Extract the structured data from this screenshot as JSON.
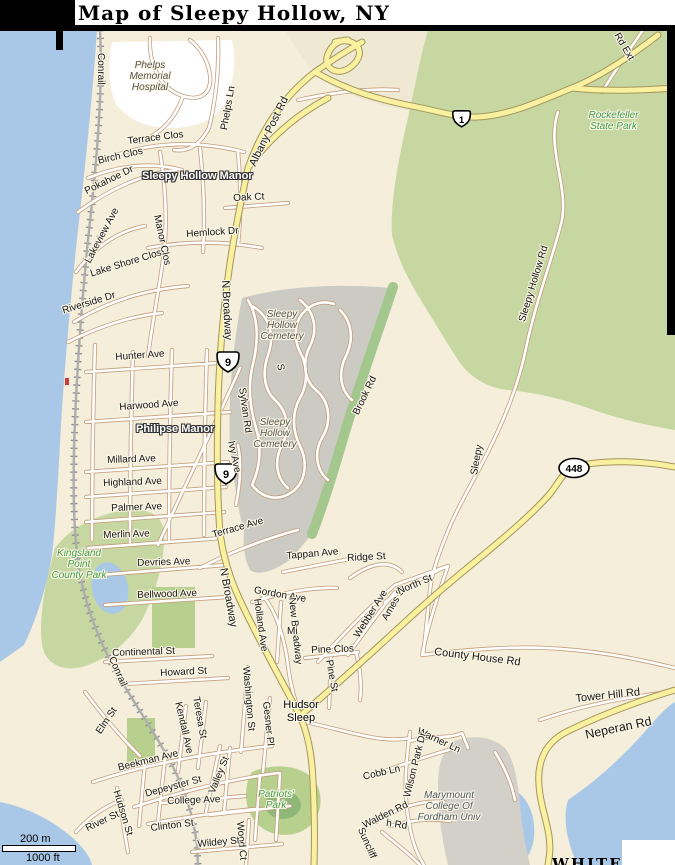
{
  "title": "Map of Sleepy Hollow, NY",
  "scale_bar": {
    "metric": "200 m",
    "imperial": "1000 ft"
  },
  "route_shields": {
    "us9": "9",
    "ny448": "448",
    "route1": "1"
  },
  "colors": {
    "water": "#A9C7E6",
    "park_green": "#C6D7A1",
    "cemetery_gray": "#CBCBC3",
    "major_road": "#FAF1A0",
    "minor_casing": "#C49E7C",
    "land": "#F4EEDA"
  },
  "labels": {
    "conrail_north": "Conrail",
    "conrail_south": "Conrail",
    "phelps_hospital": "Phelps\nMemorial\nHospital",
    "phelps_ln": "Phelps Ln",
    "albany_post_rd": "Albany Post Rd",
    "rd_ext": "Rd Ext",
    "rockefeller_state_park": "Rockefeller\nState Park",
    "terrace_clos": "Terrace Clos",
    "birch_clos": "Birch Clos",
    "sleepy_hollow_manor": "Sleepy Hollow Manor",
    "pokahoe_dr": "Pokahoe Dr",
    "oak_ct": "Oak Ct",
    "lakeview_ave": "Lakeview Ave",
    "manor_clos": "Manor Clos",
    "hemlock_dr": "Hemlock Dr",
    "lake_shore_clos": "Lake Shore Clos",
    "riverside_dr": "Riverside Dr",
    "n_broadway_upper": "N Broadway",
    "n_broadway_lower": "N Broadway",
    "hunter_ave": "Hunter Ave",
    "sleepy_hollow_cemetery_1": "Sleepy\nHollow\nCemetery",
    "sleepy_hollow_cemetery_2": "Sleepy\nHollow\nCemetery",
    "brook_rd": "Brook Rd",
    "sleepy_hollow_rd": "Sleepy Hollow Rd",
    "sleepy_partial": "Sleepy",
    "s_partial": "S",
    "harwood_ave": "Harwood Ave",
    "philipse_manor": "Philipse Manor",
    "millard_ave": "Millard Ave",
    "sylvan_rd": "Sylvan Rd",
    "ivy_ave": "Ivy Ave",
    "highland_ave": "Highland Ave",
    "palmer_ave": "Palmer Ave",
    "merlin_ave": "Merlin Ave",
    "terrace_ave": "Terrace Ave",
    "kingsland_park": "Kingsland\nPoint\nCounty Park",
    "devries_ave": "Devries Ave",
    "tappan_ave": "Tappan Ave",
    "ridge_st": "Ridge St",
    "webber_ave": "Webber Ave",
    "ames_st": "Ames St",
    "north_st": "North St",
    "gordon_ave": "Gordon Ave",
    "bellwood_ave": "Bellwood Ave",
    "county_house_rd": "County House Rd",
    "holland_ave": "Holland Ave",
    "new_broadway": "New Broadway",
    "mi_partial": "Mi",
    "pine_clos": "Pine Clos",
    "pine_st": "Pine St",
    "continental_st": "Continental St",
    "howard_st": "Howard St",
    "elm_st": "Elm St",
    "washington_st": "Washington St",
    "teresa_st": "Teresa St",
    "kendall_ave": "Kendall Ave",
    "gesner_pl": "Gesner Pl",
    "hudson_sleepy": "Hudsor\nSleep",
    "tower_hill_rd": "Tower Hill Rd",
    "neperan_rd": "Neperan Rd",
    "warner_ln": "Warner Ln",
    "wilson_park_dr": "Wilson Park Dr",
    "cobb_ln": "Cobb Ln",
    "marymount": "Marymount\nCollege Of\nFordham Univ",
    "walden_rd": "Walden Rd",
    "beekman_ave": "Beekman Ave",
    "depeyster_st": "Depeyster St",
    "hudson_st": "Hudson St",
    "river_st": "River St",
    "college_ave": "College Ave",
    "clinton_st": "Clinton St",
    "valley_st": "Valley St",
    "patriots_park": "Patriots'\nPark",
    "wood_ct": "Wood Ct",
    "wildey_st": "Wildey St",
    "suncliff": "Suncliff",
    "h_rd": "h Rd",
    "white_cutoff": "WHITE"
  }
}
